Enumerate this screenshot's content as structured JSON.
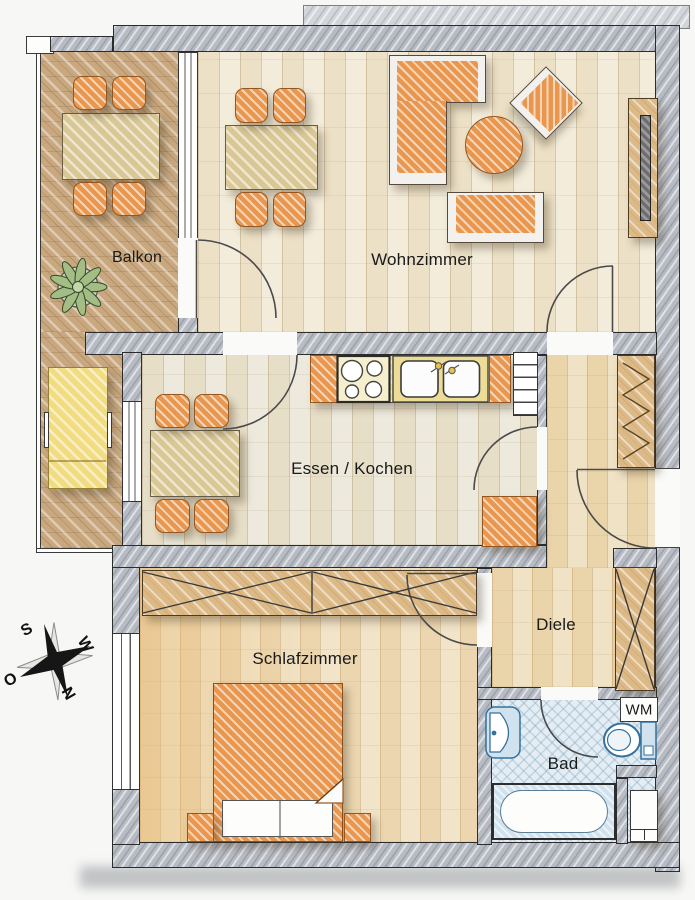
{
  "rooms": {
    "balkon": "Balkon",
    "wohnzimmer": "Wohnzimmer",
    "essen_kochen": "Essen / Kochen",
    "diele": "Diele",
    "schlafzimmer": "Schlafzimmer",
    "bad": "Bad",
    "wm": "WM"
  },
  "compass": {
    "north": "N",
    "east": "O",
    "south": "S",
    "west": "W"
  },
  "colors": {
    "wall": "#b7bbc3",
    "furniture_orange": "#e9964e",
    "table_khaki": "#d9c795",
    "wood_floor": "#f3ecda",
    "balcony_floor": "#c9a87f",
    "bath_floor": "#e3edf3",
    "fixture_blue": "#34719c",
    "lounger_yellow": "#f2dc82"
  }
}
